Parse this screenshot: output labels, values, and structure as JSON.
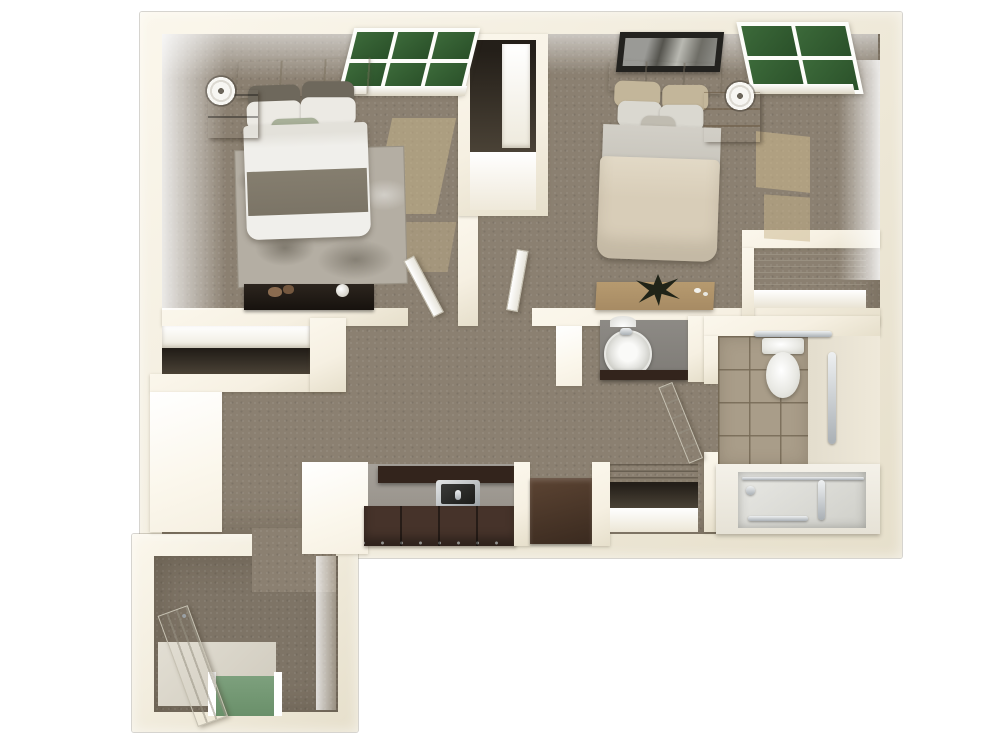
{
  "scene": {
    "type": "3d-floor-plan-top-view",
    "description": "Two-bedroom one-bath apartment floor plan rendered in 3D top-down view on a white background",
    "text_visible": "none"
  },
  "colors": {
    "page_bg": "#ffffff",
    "wall": "#f6f0e2",
    "wall_bright": "#fbf7ec",
    "wall_shade": "#e6dfcb",
    "carpet": "#8b8071",
    "carpet_dark": "#7e7466",
    "rug": "#b4aea3",
    "tile_bath": "#a99d89",
    "glass_green": "#2a5029",
    "door_gap_green": "#7da07d",
    "espresso": "#46332a",
    "espresso_dark": "#33241c",
    "counter_gray": "#99948c",
    "vanity_gray": "#7f7c77",
    "chrome": "#aab0b5",
    "white_fixture": "#f4f4f1",
    "headboard_tan": "#cdc3ab",
    "pillow_gray": "#6e685c",
    "pillow_white": "#eceae4",
    "accent_sage": "#a8b099",
    "duvet_white": "#f0efeb",
    "duvet_band": "#7b7466",
    "bed2_tan": "#d8cdb8",
    "bed2_gray": "#c7c4bb",
    "bed2_pillow": "#c3b69a",
    "wood_dark": "#4e3a29",
    "wood_light": "#a8895f",
    "desk_wood": "#a78b64",
    "frame_black": "#23221f",
    "sun_patch": "#c9b68c",
    "closet_dark": "#241f19"
  },
  "rooms": [
    {
      "id": "bedroom-1",
      "label": "Bedroom 1",
      "contents": [
        "bed",
        "headboard",
        "pillows",
        "area-rug",
        "nightstand",
        "table-lamp",
        "dresser",
        "decor-spheres",
        "window",
        "closet"
      ]
    },
    {
      "id": "bedroom-2",
      "label": "Bedroom 2",
      "contents": [
        "bed",
        "headboard",
        "pillows",
        "nightstand",
        "table-lamp",
        "desk",
        "plant",
        "wall-art",
        "corner-window",
        "wire-shelf-closet"
      ]
    },
    {
      "id": "living-area",
      "label": "Living Area",
      "contents": [
        "coat-closet-with-shelf"
      ]
    },
    {
      "id": "kitchen",
      "label": "Kitchen",
      "contents": [
        "upper-cabinets",
        "lower-cabinets",
        "stainless-sink",
        "refrigerator",
        "peninsula-wall"
      ]
    },
    {
      "id": "vanity-nook",
      "label": "Vanity Nook",
      "contents": [
        "round-sink",
        "gray-counter",
        "drawer-front",
        "wall-light"
      ]
    },
    {
      "id": "bathroom",
      "label": "Bathroom",
      "contents": [
        "toilet",
        "tan-tile-floor",
        "vertical-grab-bar",
        "towel-bar",
        "tub-shower",
        "glass-door",
        "shower-head",
        "bathroom-door"
      ]
    },
    {
      "id": "linen-closet",
      "label": "Linen Closet",
      "contents": [
        "wire-shelving"
      ]
    },
    {
      "id": "entry",
      "label": "Entry",
      "contents": [
        "front-door",
        "tile-landing",
        "door-threshold-opening"
      ]
    }
  ]
}
